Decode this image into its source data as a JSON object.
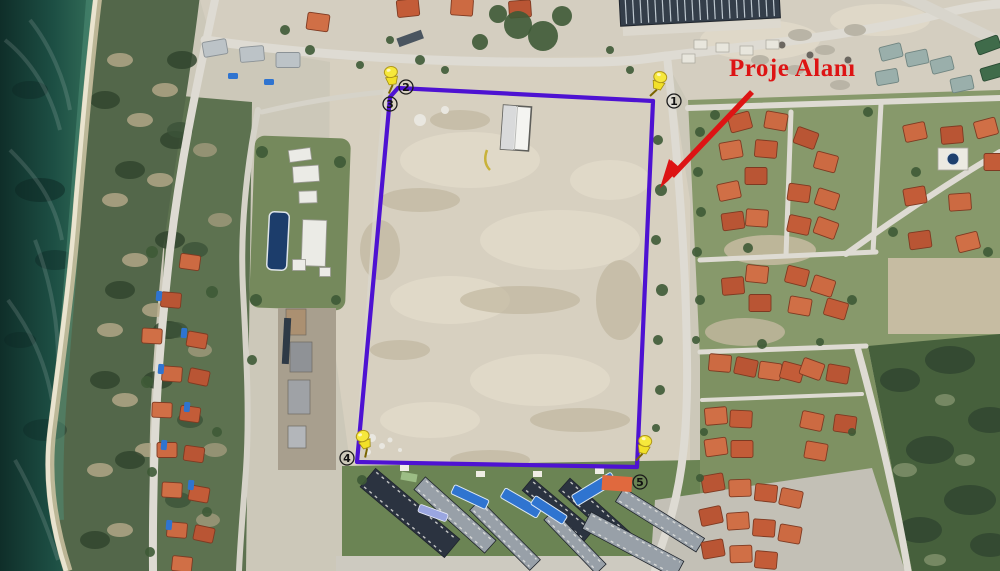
{
  "annotation": {
    "label": "Proje Alanı"
  },
  "markers": [
    {
      "label": "1",
      "x": 674,
      "y": 101
    },
    {
      "label": "2",
      "x": 406,
      "y": 87
    },
    {
      "label": "3",
      "x": 390,
      "y": 104
    },
    {
      "label": "4",
      "x": 347,
      "y": 458
    },
    {
      "label": "5",
      "x": 640,
      "y": 482
    }
  ],
  "colors": {
    "boundary_purple": "#4e12d2",
    "annotation_red": "#dd1414",
    "pin_yellow": "#f2e028",
    "roof_orange": "#c75f3a",
    "pool_blue": "#2f74d0",
    "sea_deep": "#123731",
    "sea_shallow": "#3f7a5f"
  }
}
